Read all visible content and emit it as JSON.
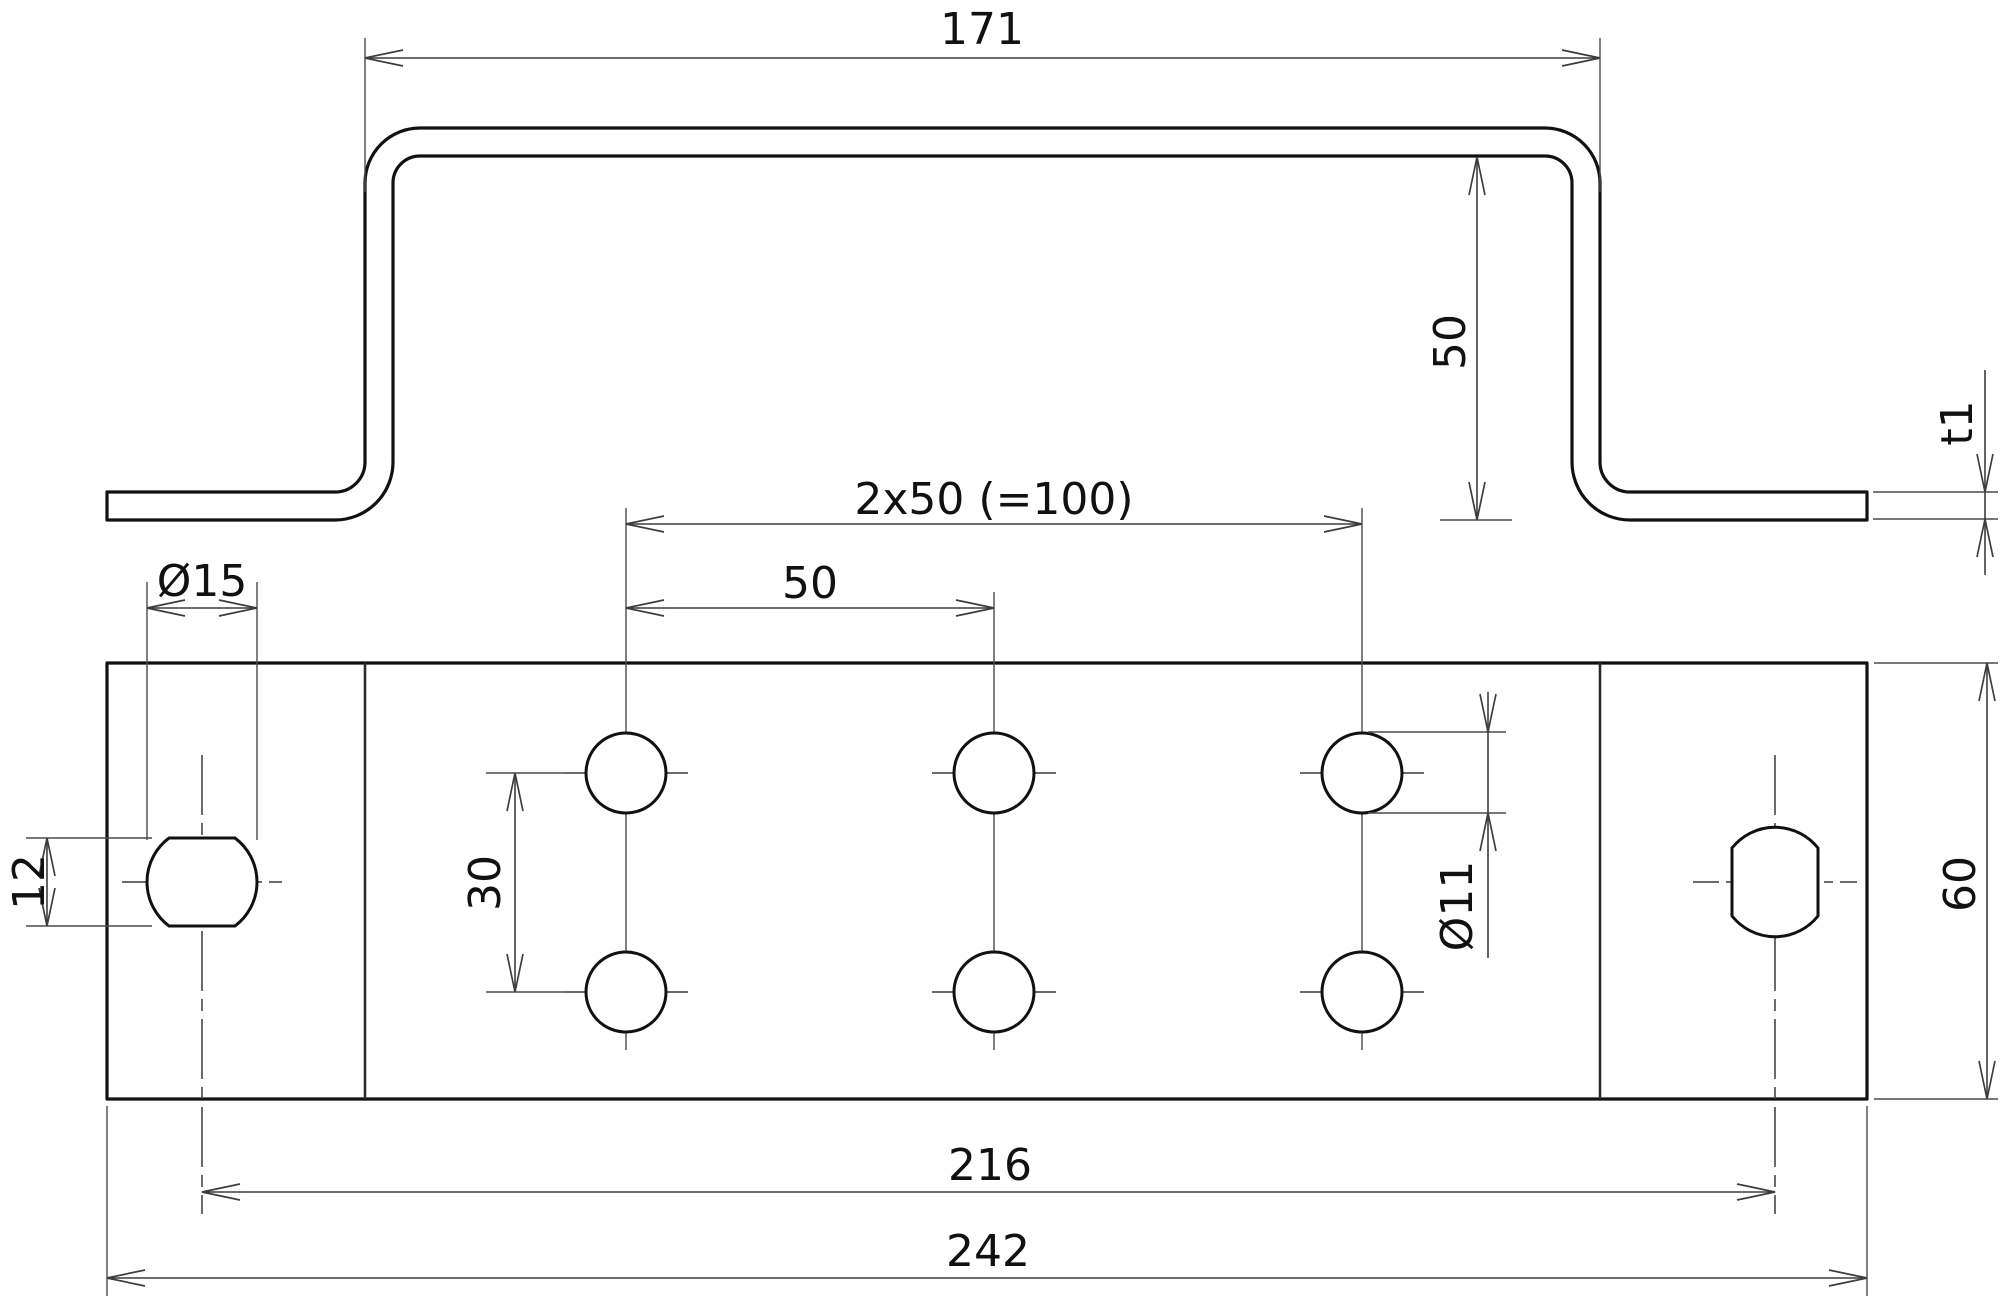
{
  "drawing": {
    "type": "2-view dimensioned technical drawing of a sheet-metal hat-profile bracket",
    "units_implied": "mm",
    "colors": {
      "outline": "#111111",
      "dimension_lines": "#3d3d3d",
      "background": "#ffffff"
    },
    "profile_view": {
      "description": "side elevation of hat-shaped bent bracket with two feet",
      "overall_top_width": 171,
      "height": 50,
      "thickness_label": "t1"
    },
    "plan_view": {
      "description": "top view of base plate with hole pattern",
      "plate_length": 242,
      "plate_width": 60,
      "bolt_holes": {
        "count": 6,
        "diameter": 11,
        "column_spacing": 50,
        "row_spacing": 30
      },
      "end_holes": {
        "count": 2,
        "diameter": 15,
        "across_flats": 12,
        "center_distance": 216
      }
    }
  },
  "dims": {
    "d171": {
      "label": "171"
    },
    "d50h": {
      "label": "50"
    },
    "dt1": {
      "label": "t1"
    },
    "d2x50": {
      "label": "2x50 (=100)"
    },
    "d50": {
      "label": "50"
    },
    "dia15": {
      "label": "Ø15"
    },
    "d12": {
      "label": "12"
    },
    "d30": {
      "label": "30"
    },
    "dia11": {
      "label": "Ø11"
    },
    "d216": {
      "label": "216"
    },
    "d242": {
      "label": "242"
    },
    "d60": {
      "label": "60"
    }
  }
}
